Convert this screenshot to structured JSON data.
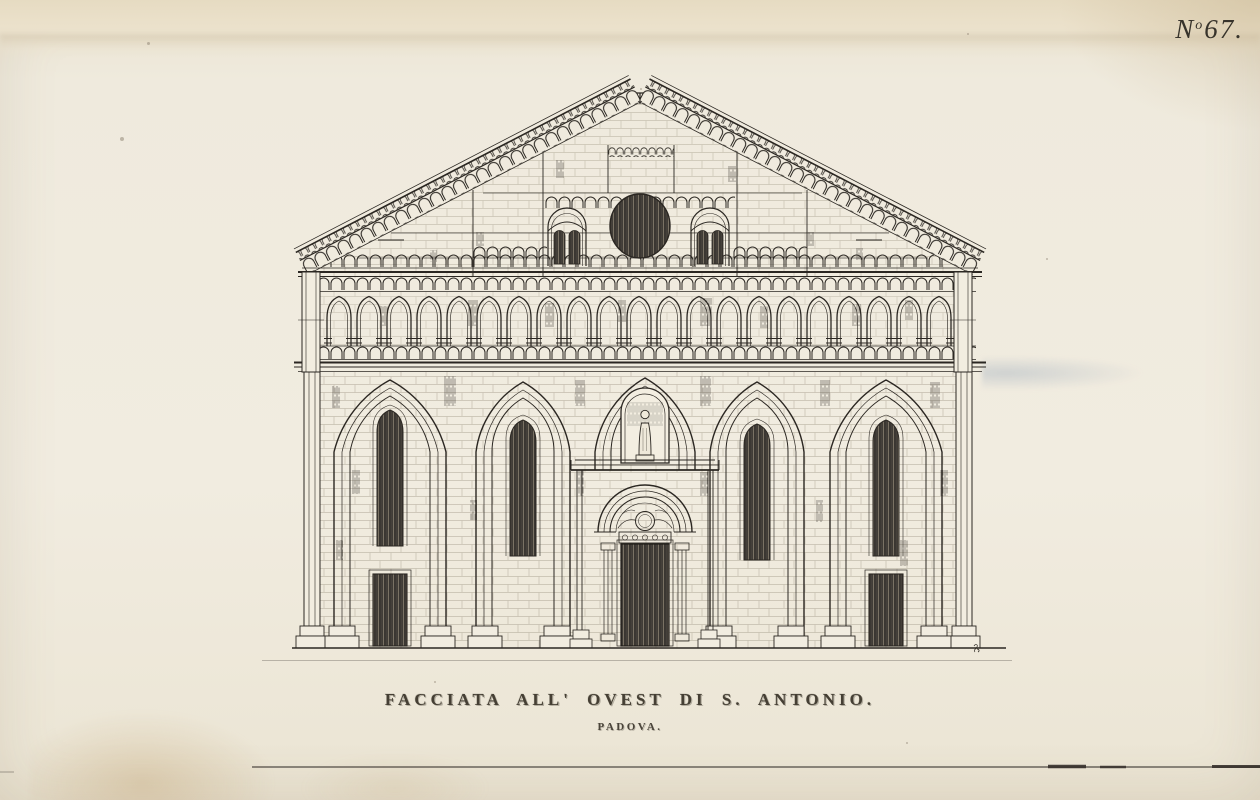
{
  "page": {
    "plate_label": {
      "prefix": "N",
      "superscript": "o",
      "number": "67."
    },
    "caption": {
      "title": "FACCIATA ALL' OVEST DI S. ANTONIO.",
      "subtitle": "PADOVA."
    },
    "drawing": {
      "subject": "West facade elevation of S. Antonio, Padova",
      "plate_number": "67"
    },
    "colors": {
      "paper": "#efe9da",
      "ink": "#2b2722",
      "foxing": "#bf9c66",
      "smudge_blue": "#8499ae"
    }
  }
}
